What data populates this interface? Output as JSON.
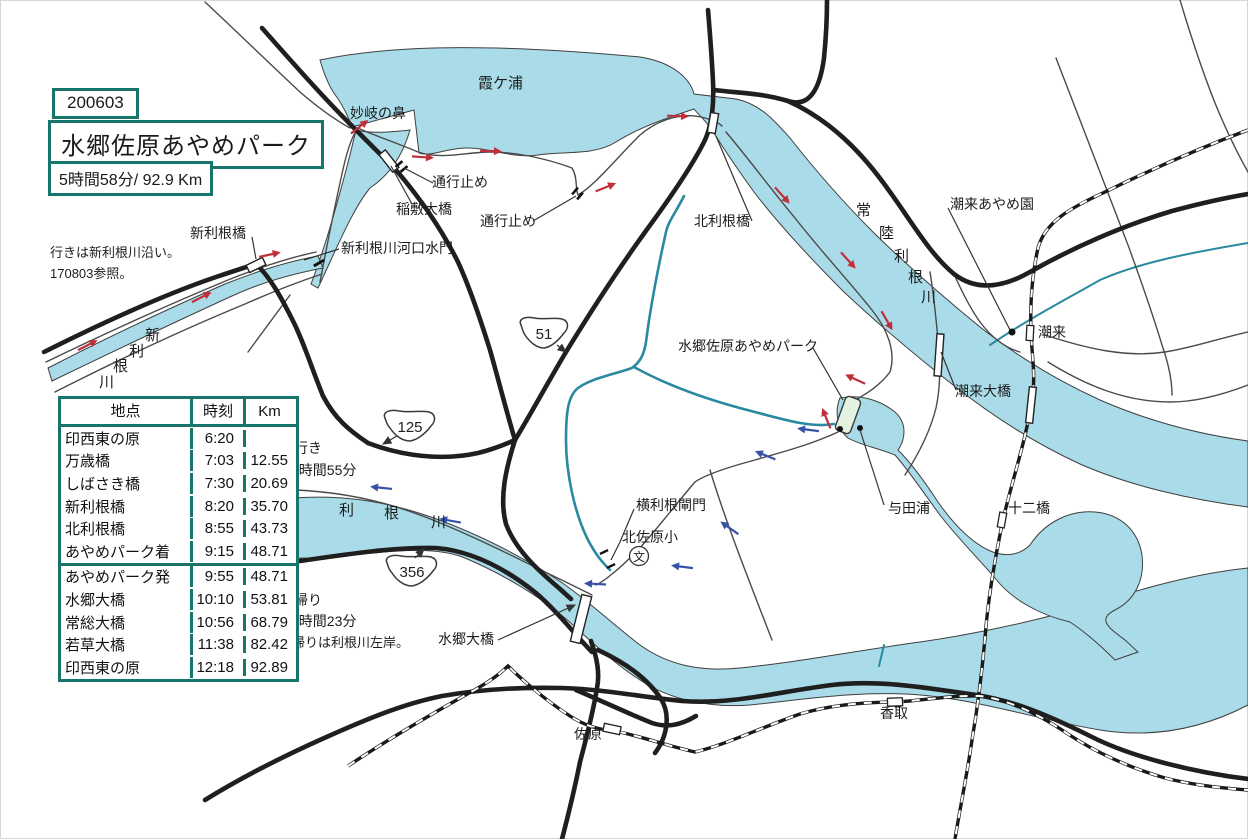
{
  "header": {
    "date_label": "200603",
    "title": "水郷佐原あやめパーク",
    "summary": "5時間58分/ 92.9 Km"
  },
  "table": {
    "headers": [
      "地点",
      "時刻",
      "Km"
    ],
    "outbound_rows": [
      [
        "印西東の原",
        "6:20",
        ""
      ],
      [
        "万歳橋",
        "7:03",
        "12.55"
      ],
      [
        "しばさき橋",
        "7:30",
        "20.69"
      ],
      [
        "新利根橋",
        "8:20",
        "35.70"
      ],
      [
        "北利根橋",
        "8:55",
        "43.73"
      ],
      [
        "あやめパーク着",
        "9:15",
        "48.71"
      ]
    ],
    "return_rows": [
      [
        "あやめパーク発",
        "9:55",
        "48.71"
      ],
      [
        "水郷大橋",
        "10:10",
        "53.81"
      ],
      [
        "常総大橋",
        "10:56",
        "68.79"
      ],
      [
        "若草大橋",
        "11:38",
        "82.42"
      ],
      [
        "印西東の原",
        "12:18",
        "92.89"
      ]
    ]
  },
  "map": {
    "shields": [
      {
        "number": "51"
      },
      {
        "number": "125"
      },
      {
        "number": "356"
      }
    ],
    "school_label": "文"
  },
  "map_labels": [
    {
      "id": "kasumigaura",
      "text": "霞ケ浦",
      "x": 478,
      "y": 76,
      "fs": 15
    },
    {
      "id": "myogi-no-hana",
      "text": "妙岐の鼻",
      "x": 350,
      "y": 106,
      "fs": 14
    },
    {
      "id": "closed-1",
      "text": "通行止め",
      "x": 432,
      "y": 175,
      "fs": 14
    },
    {
      "id": "inashiki-ohashi",
      "text": "稲敷大橋",
      "x": 396,
      "y": 202,
      "fs": 14
    },
    {
      "id": "closed-2",
      "text": "通行止め",
      "x": 480,
      "y": 214,
      "fs": 14
    },
    {
      "id": "shintone-sluice",
      "text": "新利根川河口水門",
      "x": 341,
      "y": 241,
      "fs": 14
    },
    {
      "id": "shintonebashi",
      "text": "新利根橋",
      "x": 190,
      "y": 226,
      "fs": 14
    },
    {
      "id": "outbound-note-1",
      "text": "行きは新利根川沿い。",
      "x": 50,
      "y": 246,
      "fs": 13
    },
    {
      "id": "outbound-note-2",
      "text": "170803参照。",
      "x": 50,
      "y": 267,
      "fs": 13
    },
    {
      "id": "kitatonebashi",
      "text": "北利根橋",
      "x": 694,
      "y": 214,
      "fs": 14
    },
    {
      "id": "itako-ayameen",
      "text": "潮来あやめ園",
      "x": 950,
      "y": 197,
      "fs": 14
    },
    {
      "id": "itako",
      "text": "潮来",
      "x": 1038,
      "y": 325,
      "fs": 14
    },
    {
      "id": "itako-ohashi",
      "text": "潮来大橋",
      "x": 955,
      "y": 384,
      "fs": 14
    },
    {
      "id": "park",
      "text": "水郷佐原あやめパーク",
      "x": 678,
      "y": 339,
      "fs": 14
    },
    {
      "id": "yodaura",
      "text": "与田浦",
      "x": 888,
      "y": 501,
      "fs": 14
    },
    {
      "id": "junibashi",
      "text": "十二橋",
      "x": 1008,
      "y": 501,
      "fs": 14
    },
    {
      "id": "yokotone-lock",
      "text": "横利根閘門",
      "x": 636,
      "y": 498,
      "fs": 14
    },
    {
      "id": "kitasahara-school",
      "text": "北佐原小",
      "x": 622,
      "y": 530,
      "fs": 14
    },
    {
      "id": "outbound-time-label",
      "text": "行き",
      "x": 294,
      "y": 441,
      "fs": 14
    },
    {
      "id": "outbound-time",
      "text": "2時間55分",
      "x": 291,
      "y": 463,
      "fs": 14
    },
    {
      "id": "return-time-label",
      "text": "帰り",
      "x": 294,
      "y": 593,
      "fs": 14
    },
    {
      "id": "return-time",
      "text": "2時間23分",
      "x": 291,
      "y": 614,
      "fs": 14
    },
    {
      "id": "return-note",
      "text": "帰りは利根川左岸。",
      "x": 292,
      "y": 636,
      "fs": 13
    },
    {
      "id": "suigo-ohashi",
      "text": "水郷大橋",
      "x": 438,
      "y": 632,
      "fs": 14
    },
    {
      "id": "sawara",
      "text": "佐原",
      "x": 574,
      "y": 727,
      "fs": 14
    },
    {
      "id": "katori",
      "text": "香取",
      "x": 880,
      "y": 706,
      "fs": 14
    },
    {
      "id": "shintone-river-name",
      "text": "新利根川",
      "fs": 15,
      "chars": [
        {
          "ch": "新",
          "x": 145,
          "y": 328
        },
        {
          "ch": "利",
          "x": 129,
          "y": 344
        },
        {
          "ch": "根",
          "x": 113,
          "y": 359
        },
        {
          "ch": "川",
          "x": 99,
          "y": 375
        }
      ]
    },
    {
      "id": "hitachitone-river-name",
      "text": "常陸利根川",
      "fs": 15,
      "chars": [
        {
          "ch": "常",
          "x": 856,
          "y": 203
        },
        {
          "ch": "陸",
          "x": 879,
          "y": 226
        },
        {
          "ch": "利",
          "x": 894,
          "y": 249
        },
        {
          "ch": "根",
          "x": 908,
          "y": 270
        },
        {
          "ch": "川",
          "x": 921,
          "y": 290
        }
      ]
    },
    {
      "id": "tone-river-name",
      "text": "利根川",
      "fs": 15,
      "chars": [
        {
          "ch": "利",
          "x": 339,
          "y": 503
        },
        {
          "ch": "根",
          "x": 384,
          "y": 506
        },
        {
          "ch": "川",
          "x": 431,
          "y": 515
        }
      ]
    }
  ],
  "colors": {
    "teal": "#17756b",
    "water": "#a9dce8",
    "channel": "#2a89a0",
    "road": "#1f1f1f",
    "route-out": "#c0303a",
    "route-back": "#3753a8"
  }
}
